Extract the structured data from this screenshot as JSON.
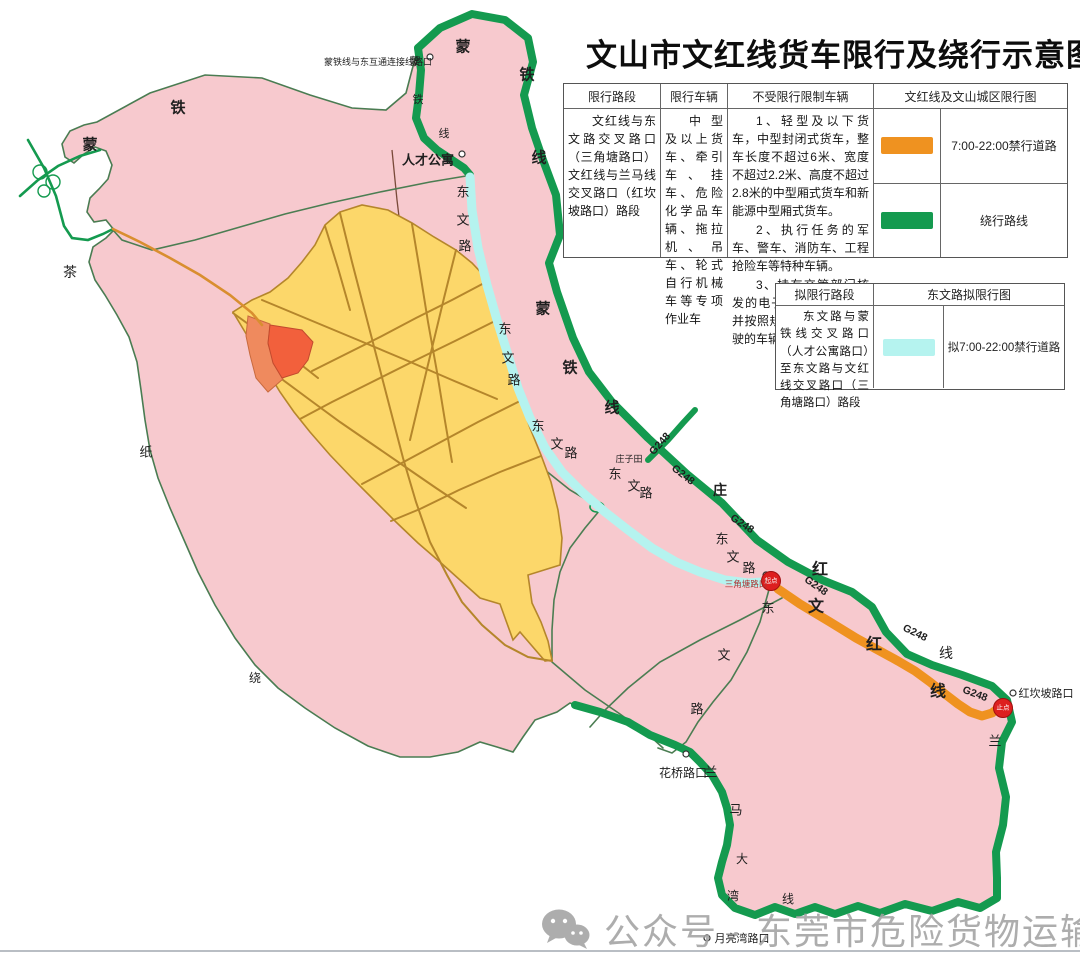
{
  "title": "文山市文红线货车限行及绕行示意图",
  "restriction_table": {
    "headers": [
      "限行路段",
      "限行车辆",
      "不受限行限制车辆",
      "文红线及文山城区限行图"
    ],
    "segment": "文红线与东文路交叉路口（三角塘路口）文红线与兰马线交叉路口（红坎坡路口）路段",
    "vehicles": "中型及以上货车、牵引车、挂车、危险化学品车辆、拖拉机、吊车、轮式自行机械车等专项作业车",
    "exempt_items": [
      "1、轻型及以下货车，中型封闭式货车，整车长度不超过6米、宽度不超过2.2米、高度不超过2.8米的中型厢式货车和新能源中型厢式货车。",
      "2、执行任务的军车、警车、消防车、工程抢险车等特种车辆。",
      "3、持有交管部门核发的电子通行码（证），并按照规定时间和路线行驶的车辆。"
    ],
    "legend": [
      {
        "color": "#ef9220",
        "label": "7:00-22:00禁行道路"
      },
      {
        "color": "#149a4f",
        "label": "绕行路线"
      }
    ]
  },
  "planned_table": {
    "headers": [
      "拟限行路段",
      "东文路拟限行图"
    ],
    "segment": "东文路与蒙铁线交叉路口（人才公寓路口）至东文路与文红线交叉路口（三角塘路口）路段",
    "legend": [
      {
        "color": "#b5f3ef",
        "label": "拟7:00-22:00禁行道路"
      }
    ]
  },
  "watermark": "公众号 · 东莞市危险货物运输协会",
  "map": {
    "palette": {
      "pink": "#f7c9ce",
      "pinkBorder": "#4a7c52",
      "yellow": "#fcd76a",
      "yellowBorder": "#b5862b",
      "red1": "#f2603c",
      "red2": "#ef8a5e",
      "green": "#149a4f",
      "cyan": "#b5f3ef",
      "orange": "#ef9220",
      "thinRoad": "#4b7d52",
      "orangeRoad": "#d98e2f"
    },
    "endpoints": [
      {
        "label": "起点",
        "x": 771,
        "y": 581
      },
      {
        "label": "止点",
        "x": 1003,
        "y": 708
      }
    ],
    "markers": [
      {
        "name": "蒙铁线连接线路口",
        "x": 430,
        "y": 57
      },
      {
        "name": "人才公寓",
        "x": 462,
        "y": 154
      },
      {
        "name": "三角塘路口",
        "x": 766,
        "y": 575
      },
      {
        "name": "红坎坡路口",
        "x": 1013,
        "y": 693
      },
      {
        "name": "花桥路口",
        "x": 686,
        "y": 754
      },
      {
        "name": "月亮湾路口",
        "x": 707,
        "y": 938
      }
    ],
    "labels": [
      {
        "t": "蒙铁线与东互通连接线路口",
        "x": 378,
        "y": 62,
        "s": 9
      },
      {
        "t": "人才公寓",
        "x": 428,
        "y": 160,
        "s": 13,
        "b": 1
      },
      {
        "t": "蒙",
        "x": 463,
        "y": 47,
        "s": 15,
        "b": 1
      },
      {
        "t": "铁",
        "x": 527,
        "y": 75,
        "s": 15,
        "b": 1
      },
      {
        "t": "线",
        "x": 539,
        "y": 158,
        "s": 15,
        "b": 1
      },
      {
        "t": "蒙",
        "x": 415,
        "y": 62,
        "s": 11
      },
      {
        "t": "铁",
        "x": 418,
        "y": 100,
        "s": 11
      },
      {
        "t": "线",
        "x": 444,
        "y": 134,
        "s": 11
      },
      {
        "t": "铁",
        "x": 178,
        "y": 108,
        "s": 15,
        "b": 1
      },
      {
        "t": "蒙",
        "x": 90,
        "y": 145,
        "s": 15,
        "b": 1
      },
      {
        "t": "茶",
        "x": 70,
        "y": 272,
        "s": 14
      },
      {
        "t": "纸",
        "x": 146,
        "y": 452,
        "s": 13
      },
      {
        "t": "绕",
        "x": 255,
        "y": 678,
        "s": 12
      },
      {
        "t": "蒙",
        "x": 543,
        "y": 309,
        "s": 15,
        "b": 1
      },
      {
        "t": "铁",
        "x": 570,
        "y": 368,
        "s": 15,
        "b": 1
      },
      {
        "t": "线",
        "x": 612,
        "y": 408,
        "s": 15,
        "b": 1
      },
      {
        "t": "G248",
        "x": 660,
        "y": 444,
        "s": 10.5,
        "b": 1,
        "r": -48
      },
      {
        "t": "G248",
        "x": 683,
        "y": 475,
        "s": 10.5,
        "b": 1,
        "r": 38
      },
      {
        "t": "G248",
        "x": 742,
        "y": 524,
        "s": 10.5,
        "b": 1,
        "r": 33
      },
      {
        "t": "G248",
        "x": 816,
        "y": 586,
        "s": 10.5,
        "b": 1,
        "r": 35
      },
      {
        "t": "G248",
        "x": 915,
        "y": 633,
        "s": 10.5,
        "b": 1,
        "r": 26
      },
      {
        "t": "G248",
        "x": 975,
        "y": 694,
        "s": 10.5,
        "b": 1,
        "r": 20
      },
      {
        "t": "红",
        "x": 820,
        "y": 570,
        "s": 16,
        "b": 1
      },
      {
        "t": "文",
        "x": 816,
        "y": 607,
        "s": 16,
        "b": 1
      },
      {
        "t": "红",
        "x": 874,
        "y": 645,
        "s": 16,
        "b": 1
      },
      {
        "t": "线",
        "x": 938,
        "y": 692,
        "s": 16,
        "b": 1
      },
      {
        "t": "线",
        "x": 946,
        "y": 653,
        "s": 14
      },
      {
        "t": "庄",
        "x": 720,
        "y": 490,
        "s": 14,
        "b": 1
      },
      {
        "t": "庄子田",
        "x": 629,
        "y": 459,
        "s": 9
      },
      {
        "t": "东",
        "x": 463,
        "y": 192,
        "s": 13
      },
      {
        "t": "文",
        "x": 463,
        "y": 220,
        "s": 13
      },
      {
        "t": "路",
        "x": 465,
        "y": 246,
        "s": 13
      },
      {
        "t": "东",
        "x": 505,
        "y": 329,
        "s": 13
      },
      {
        "t": "文",
        "x": 508,
        "y": 358,
        "s": 13
      },
      {
        "t": "路",
        "x": 514,
        "y": 380,
        "s": 13
      },
      {
        "t": "东",
        "x": 538,
        "y": 426,
        "s": 13
      },
      {
        "t": "文",
        "x": 557,
        "y": 444,
        "s": 13
      },
      {
        "t": "路",
        "x": 571,
        "y": 453,
        "s": 13
      },
      {
        "t": "东",
        "x": 615,
        "y": 474,
        "s": 13
      },
      {
        "t": "文",
        "x": 634,
        "y": 486,
        "s": 13
      },
      {
        "t": "路",
        "x": 646,
        "y": 493,
        "s": 13
      },
      {
        "t": "东",
        "x": 722,
        "y": 539,
        "s": 13
      },
      {
        "t": "文",
        "x": 733,
        "y": 557,
        "s": 13
      },
      {
        "t": "路",
        "x": 749,
        "y": 568,
        "s": 13
      },
      {
        "t": "东",
        "x": 768,
        "y": 608,
        "s": 13
      },
      {
        "t": "文",
        "x": 724,
        "y": 655,
        "s": 13
      },
      {
        "t": "路",
        "x": 697,
        "y": 709,
        "s": 13
      },
      {
        "t": "兰",
        "x": 711,
        "y": 772,
        "s": 13
      },
      {
        "t": "马",
        "x": 736,
        "y": 810,
        "s": 13
      },
      {
        "t": "大",
        "x": 742,
        "y": 859,
        "s": 12
      },
      {
        "t": "湾",
        "x": 733,
        "y": 896,
        "s": 12
      },
      {
        "t": "线",
        "x": 788,
        "y": 899,
        "s": 12
      },
      {
        "t": "兰",
        "x": 995,
        "y": 741,
        "s": 13
      },
      {
        "t": "三角塘路口",
        "x": 746,
        "y": 584,
        "s": 8.5,
        "c": "#b03232"
      },
      {
        "t": "红坎坡路口",
        "x": 1046,
        "y": 694,
        "s": 11
      },
      {
        "t": "花桥路口",
        "x": 683,
        "y": 773,
        "s": 12
      },
      {
        "t": "月亮湾路口",
        "x": 742,
        "y": 939,
        "s": 11
      }
    ]
  }
}
